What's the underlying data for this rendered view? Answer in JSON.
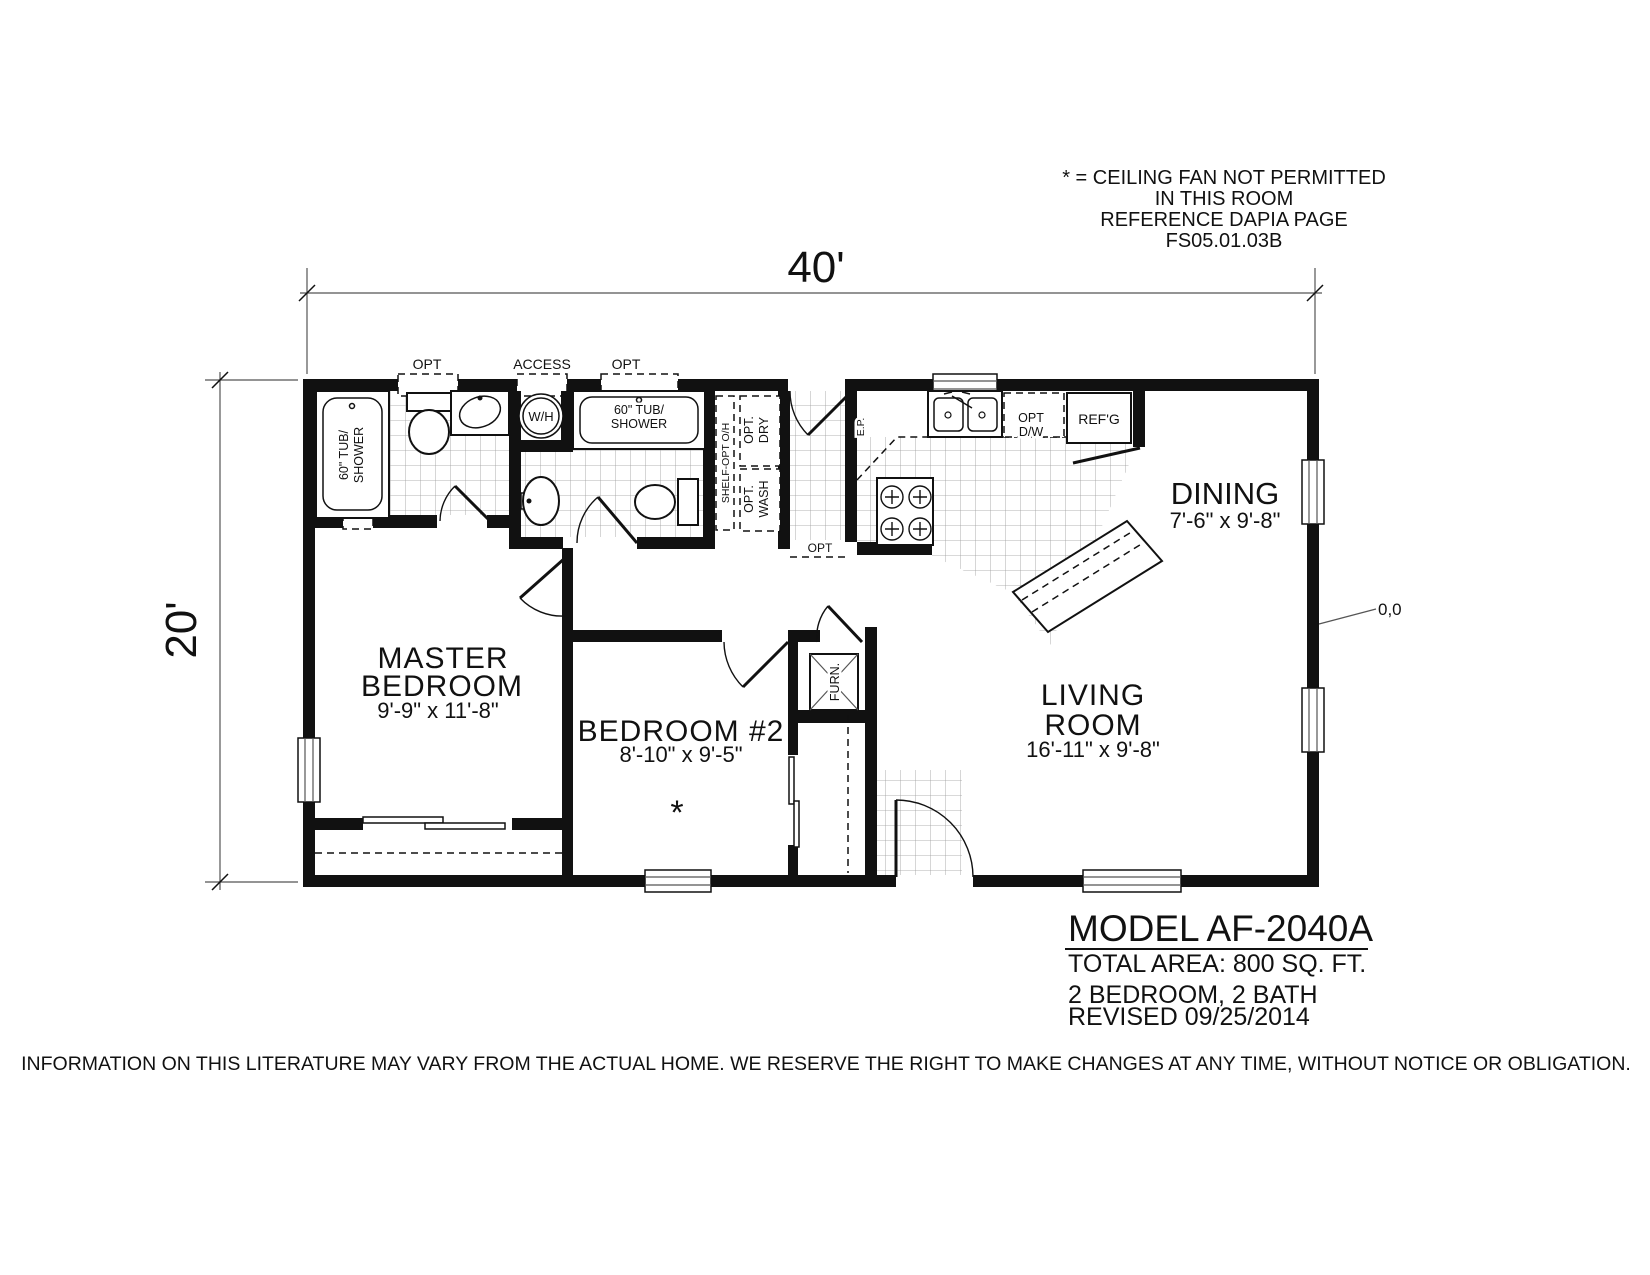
{
  "annotation": {
    "line1": "* = CEILING FAN NOT PERMITTED",
    "line2": "IN THIS ROOM",
    "line3": "REFERENCE DAPIA PAGE",
    "line4": "FS05.01.03B"
  },
  "dimensions": {
    "width_label": "40'",
    "height_label": "20'",
    "origin_label": "0,0"
  },
  "rooms": {
    "master_bedroom": {
      "line1": "MASTER",
      "line2": "BEDROOM",
      "size": "9'-9\" x 11'-8\""
    },
    "bedroom2": {
      "name": "BEDROOM #2",
      "size": "8'-10\" x 9'-5\"",
      "ceiling_fan_note": "*"
    },
    "living_room": {
      "line1": "LIVING",
      "line2": "ROOM",
      "size": "16'-11\" x 9'-8\""
    },
    "dining": {
      "name": "DINING",
      "size": "7'-6\" x 9'-8\""
    }
  },
  "fixtures": {
    "master_tub_line1": "60\" TUB/",
    "master_tub_line2": "SHOWER",
    "bath2_tub_line1": "60\" TUB/",
    "bath2_tub_line2": "SHOWER",
    "water_heater": "W/H",
    "access_label": "ACCESS",
    "opt_window1_label": "OPT",
    "opt_window2_label": "OPT",
    "opt_hall_door_label": "OPT",
    "shelf_label": "SHELF-OPT O/H",
    "dryer_line1": "OPT.",
    "dryer_line2": "DRY",
    "washer_line1": "OPT.",
    "washer_line2": "WASH",
    "electrical_panel": "E.P.",
    "dishwasher_line1": "OPT",
    "dishwasher_line2": "D/W",
    "refrigerator": "REF'G",
    "furnace": "FURN."
  },
  "title_block": {
    "model": "MODEL AF-2040A",
    "area": "TOTAL AREA: 800 SQ. FT.",
    "beds_baths": "2 BEDROOM, 2 BATH",
    "revised": "REVISED 09/25/2014"
  },
  "disclaimer": "INFORMATION ON THIS LITERATURE MAY VARY FROM THE ACTUAL HOME. WE RESERVE THE RIGHT TO MAKE CHANGES AT ANY TIME, WITHOUT NOTICE OR OBLIGATION.",
  "colors": {
    "ink": "#111111",
    "paper": "#ffffff"
  }
}
